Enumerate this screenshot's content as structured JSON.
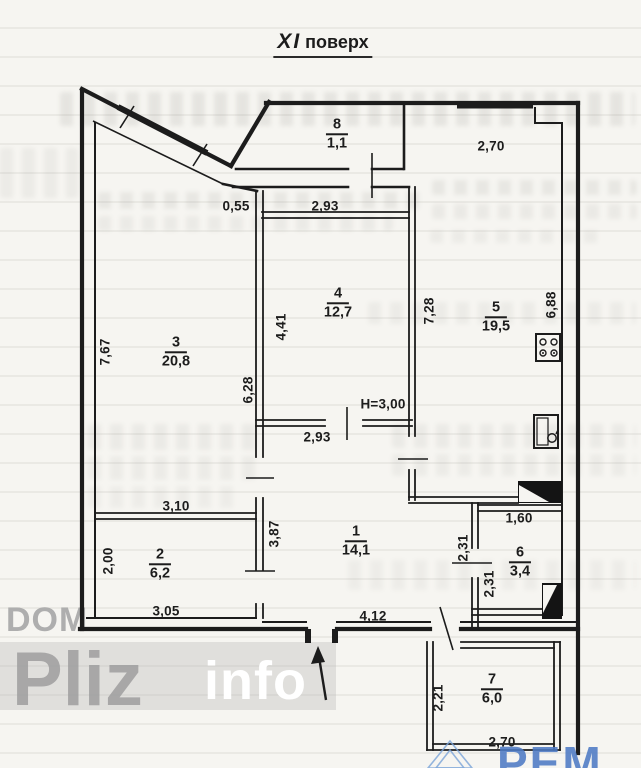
{
  "title": {
    "floor": "ХІ",
    "word": "поверх"
  },
  "rooms": [
    {
      "number": "8",
      "area": "1,1"
    },
    {
      "number": "3",
      "area": "20,8"
    },
    {
      "number": "4",
      "area": "12,7"
    },
    {
      "number": "5",
      "area": "19,5"
    },
    {
      "number": "1",
      "area": "14,1"
    },
    {
      "number": "2",
      "area": "6,2"
    },
    {
      "number": "6",
      "area": "3,4"
    },
    {
      "number": "7",
      "area": "6,0"
    }
  ],
  "dims": [
    {
      "t": "2,70"
    },
    {
      "t": "0,55"
    },
    {
      "t": "2,93"
    },
    {
      "t": "7,67"
    },
    {
      "t": "4,41"
    },
    {
      "t": "6,28"
    },
    {
      "t": "7,28"
    },
    {
      "t": "6,88"
    },
    {
      "t": "2,93"
    },
    {
      "t": "3,10"
    },
    {
      "t": "3,87"
    },
    {
      "t": "2,00"
    },
    {
      "t": "2,31"
    },
    {
      "t": "1,60"
    },
    {
      "t": "2,31"
    },
    {
      "t": "3,05"
    },
    {
      "t": "4,12"
    },
    {
      "t": "2,21"
    },
    {
      "t": "2,70"
    },
    {
      "t": "Н=3,00"
    }
  ],
  "watermarks": {
    "dom": "DOM",
    "pliz": "Pliz",
    "info": "info",
    "rem": "РЕМ"
  },
  "colors": {
    "ink": "#1c1c1c",
    "paper": "#f6f5f1",
    "watermark_gray": "#aeaeae",
    "watermark_blue": "#4d7ac4"
  }
}
